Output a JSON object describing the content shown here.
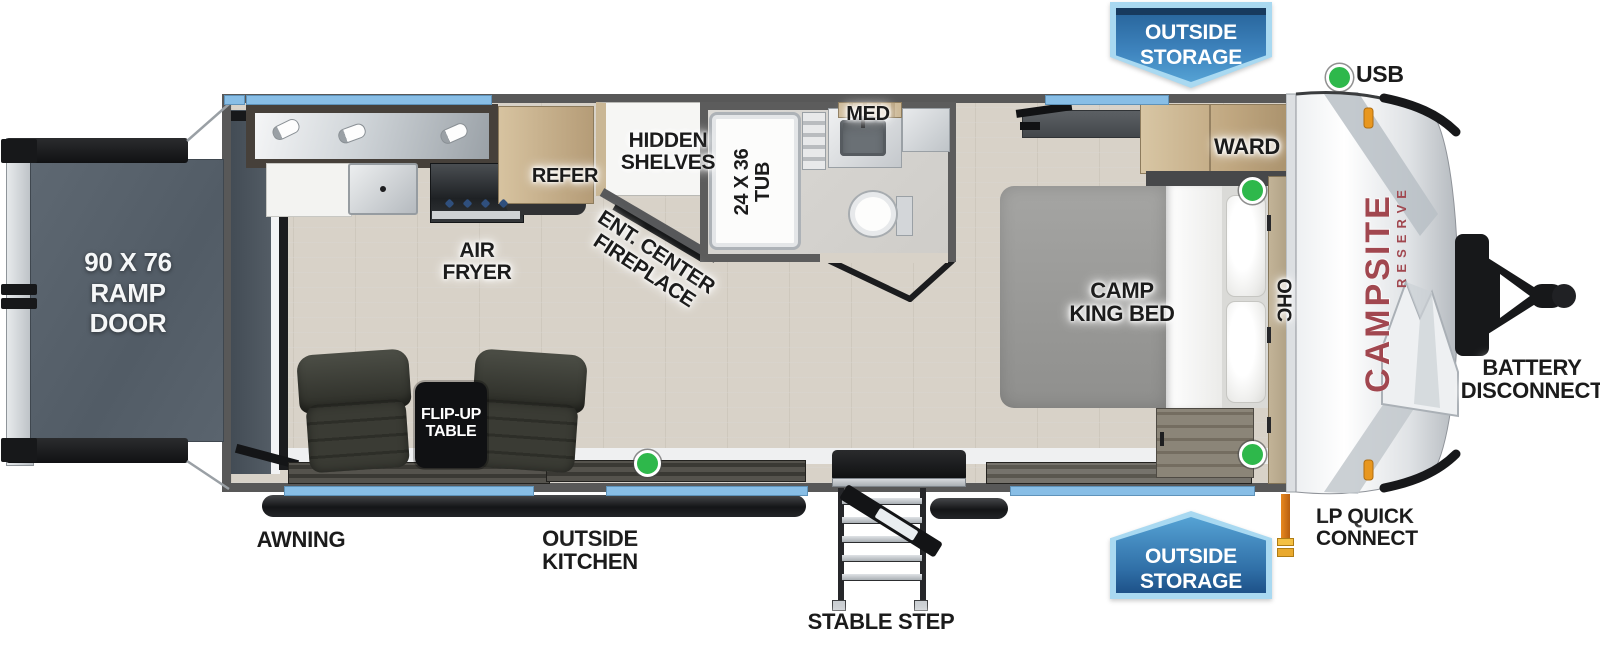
{
  "title": "Campsite Reserve travel trailer floorplan",
  "brand": {
    "name": "CAMPSITE",
    "series": "RESERVE",
    "color": "#a1474f"
  },
  "badges": {
    "top": {
      "lines": [
        "OUTSIDE",
        "STORAGE"
      ]
    },
    "bottom": {
      "lines": [
        "OUTSIDE",
        "STORAGE"
      ]
    }
  },
  "labels": {
    "usb": "USB",
    "ramp_door": [
      "90 X 76",
      "RAMP",
      "DOOR"
    ],
    "air_fryer": [
      "AIR",
      "FRYER"
    ],
    "refer": "REFER",
    "hidden_shelves": [
      "HIDDEN",
      "SHELVES"
    ],
    "ent_center_fireplace": [
      "ENT. CENTER",
      "FIREPLACE"
    ],
    "tub": [
      "24 X 36",
      "TUB"
    ],
    "med": "MED",
    "camp_king_bed": [
      "CAMP",
      "KING BED"
    ],
    "ward": "WARD",
    "ohc": "OHC",
    "flip_up_table": [
      "FLIP-UP",
      "TABLE"
    ],
    "awning": "AWNING",
    "outside_kitchen": [
      "OUTSIDE",
      "KITCHEN"
    ],
    "stable_step": "STABLE STEP",
    "lp_quick_connect": [
      "LP QUICK",
      "CONNECT"
    ],
    "battery_disconnect": [
      "BATTERY",
      "DISCONNECT"
    ]
  },
  "colors": {
    "window_blue": "#88bee6",
    "badge_border_blue": "#a9d9f1",
    "badge_fill_blue": "#2f6ea6",
    "usb_green": "#2eb84b",
    "lp_orange": "#e8891f",
    "wall_gray": "#585858",
    "brand_red": "#a1474f"
  }
}
